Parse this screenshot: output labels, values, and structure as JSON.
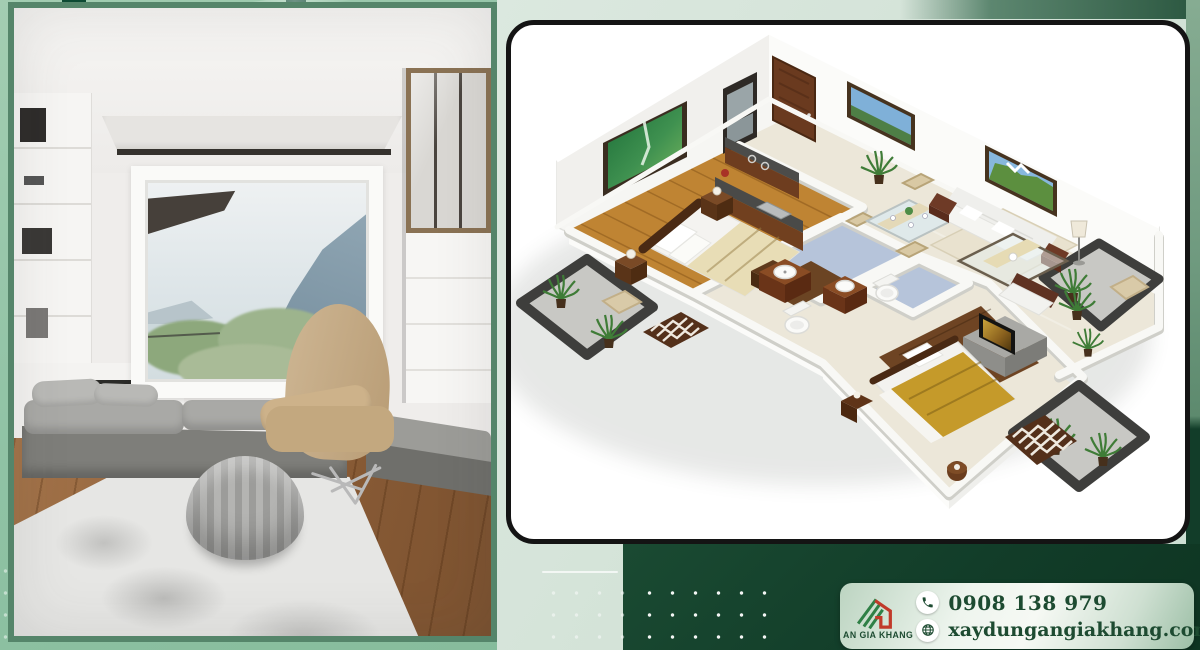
{
  "brand": {
    "name": "AN GIA KHANG"
  },
  "contact": {
    "phone": "0908 138 979",
    "website": "xaydungangiakhang.com"
  },
  "icons": {
    "logo": "house-logo-icon",
    "phone": "phone-icon",
    "website": "globe-icon"
  },
  "colors": {
    "frame_green": "#8fc2a4",
    "mint_panel": "#d4e3d8",
    "dark_green": "#123d29",
    "sage_strip": "#6f9a7f",
    "text_green": "#1d4b31",
    "logo_green": "#2f8046",
    "logo_red": "#c13a2a",
    "card_border": "#141414"
  },
  "images": {
    "left": "interior-room-photo",
    "right": "apartment-3d-floor-plan"
  }
}
